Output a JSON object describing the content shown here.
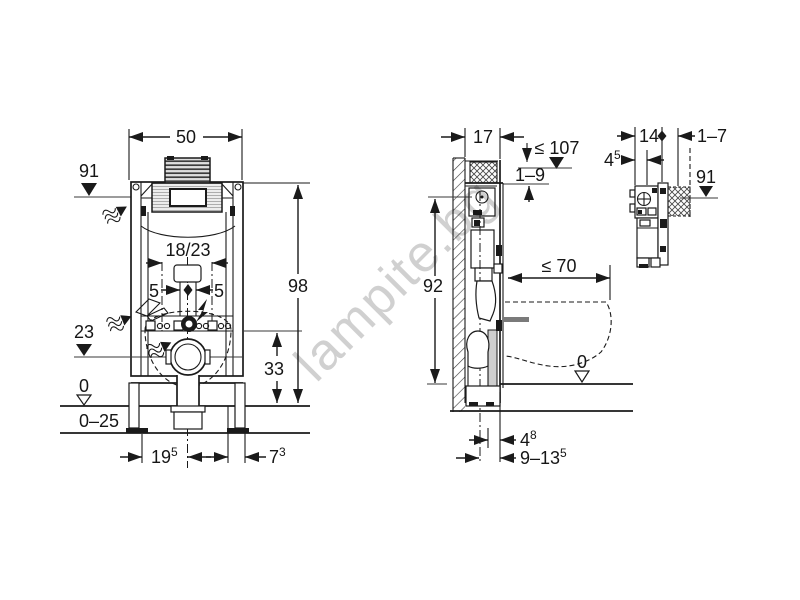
{
  "watermark": {
    "text": "lampite.bg",
    "color": "#c8c8c8"
  },
  "front_view": {
    "width_top": "50",
    "actuator_height": "91",
    "flush_bend": "18/23",
    "offset_left": "5",
    "offset_right": "5",
    "total_height": "98",
    "outlet_height": "23",
    "fixing_to_floor": "33",
    "floor_zero": "0",
    "floor_finish_range": "0–25",
    "leg_left": {
      "base": "19",
      "sup": "5"
    },
    "leg_right": {
      "base": "7",
      "sup": "3"
    }
  },
  "side_view": {
    "frame_depth": "17",
    "max_height": "≤ 107",
    "finish_range": "1–9",
    "frame_height": "92",
    "pan_depth_max": "≤ 70",
    "floor_zero": "0",
    "outlet_offset": {
      "base": "4",
      "sup": "8"
    },
    "outlet_range": {
      "base": "9–13",
      "sup": "5"
    }
  },
  "detail_view": {
    "depth": "14",
    "wall_range": "1–7",
    "offset": {
      "base": "4",
      "sup": "5"
    },
    "actuator_height": "91"
  }
}
